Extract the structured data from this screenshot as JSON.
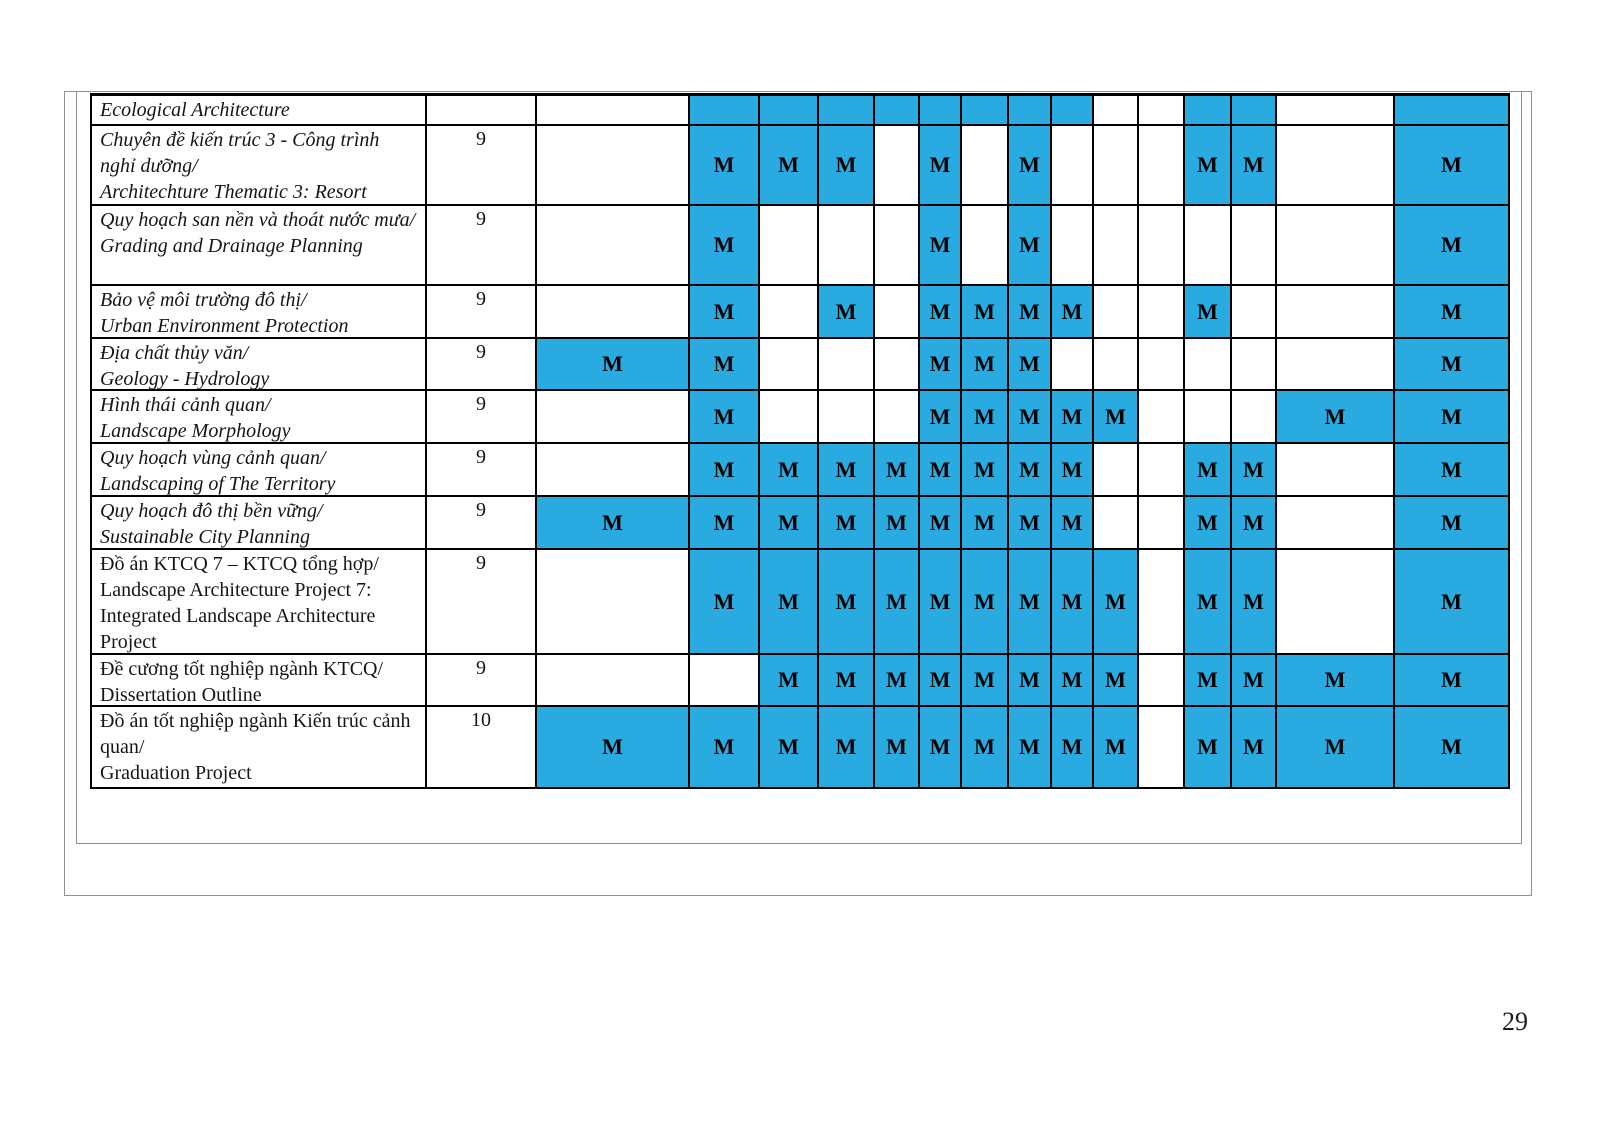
{
  "page": {
    "number": "29"
  },
  "colors": {
    "highlight": "#29ABE2",
    "grid_line": "#000000",
    "frame_line": "#8f8f8f"
  },
  "table": {
    "mark_symbol": "M",
    "name_col_width": 335,
    "semester_col_width": 110,
    "mark_col_widths": [
      153,
      70,
      59,
      56,
      45,
      42,
      47,
      43,
      42,
      45,
      46,
      47,
      45,
      118,
      115
    ],
    "rows": [
      {
        "name_vi": "",
        "name_en": "Ecological Architecture",
        "italic": true,
        "semester": "",
        "height_px": 30,
        "marks": [
          "",
          "B",
          "B",
          "B",
          "B",
          "B",
          "B",
          "B",
          "B",
          "",
          "",
          "B",
          "B",
          "",
          "B"
        ]
      },
      {
        "name_vi": "Chuyên đề kiến trúc 3 - Công trình nghỉ dưỡng/",
        "name_en": "Architechture Thematic 3: Resort",
        "italic": true,
        "semester": "9",
        "height_px": 80,
        "marks": [
          "",
          "M",
          "M",
          "M",
          "",
          "M",
          "",
          "M",
          "",
          "",
          "",
          "M",
          "M",
          "",
          "M"
        ]
      },
      {
        "name_vi": "Quy hoạch san nền và thoát nước mưa/",
        "name_en": "Grading and Drainage Planning",
        "italic": true,
        "semester": "9",
        "height_px": 80,
        "marks": [
          "",
          "M",
          "",
          "",
          "",
          "M",
          "",
          "M",
          "",
          "",
          "",
          "",
          "",
          "",
          "M"
        ]
      },
      {
        "name_vi": "Bảo vệ môi trường đô thị/",
        "name_en": "Urban Environment Protection",
        "italic": true,
        "semester": "9",
        "height_px": 53,
        "marks": [
          "",
          "M",
          "",
          "M",
          "",
          "M",
          "M",
          "M",
          "M",
          "",
          "",
          "M",
          "",
          "",
          "M"
        ]
      },
      {
        "name_vi": "Địa chất thủy văn/",
        "name_en": "Geology - Hydrology",
        "italic": true,
        "semester": "9",
        "height_px": 52,
        "marks": [
          "M",
          "M",
          "",
          "",
          "",
          "M",
          "M",
          "M",
          "",
          "",
          "",
          "",
          "",
          "",
          "M"
        ]
      },
      {
        "name_vi": "Hình thái cảnh quan/",
        "name_en": "Landscape Morphology",
        "italic": true,
        "semester": "9",
        "height_px": 53,
        "marks": [
          "",
          "M",
          "",
          "",
          "",
          "M",
          "M",
          "M",
          "M",
          "M",
          "",
          "",
          "",
          "M",
          "M"
        ]
      },
      {
        "name_vi": "Quy hoạch vùng cảnh quan/",
        "name_en": "Landscaping of The Territory",
        "italic": true,
        "semester": "9",
        "height_px": 53,
        "marks": [
          "",
          "M",
          "M",
          "M",
          "M",
          "M",
          "M",
          "M",
          "M",
          "",
          "",
          "M",
          "M",
          "",
          "M"
        ]
      },
      {
        "name_vi": "Quy hoạch đô thị bền vững/",
        "name_en": "Sustainable City Planning",
        "italic": true,
        "semester": "9",
        "height_px": 53,
        "marks": [
          "M",
          "M",
          "M",
          "M",
          "M",
          "M",
          "M",
          "M",
          "M",
          "",
          "",
          "M",
          "M",
          "",
          "M"
        ]
      },
      {
        "name_vi": "Đồ án KTCQ 7 – KTCQ tổng hợp/",
        "name_en": "Landscape Architecture Project 7: Integrated Landscape Architecture Project",
        "italic": false,
        "semester": "9",
        "height_px": 105,
        "marks": [
          "",
          "M",
          "M",
          "M",
          "M",
          "M",
          "M",
          "M",
          "M",
          "M",
          "",
          "M",
          "M",
          "",
          "M"
        ]
      },
      {
        "name_vi": "Đề cương tốt nghiệp ngành KTCQ/",
        "name_en": "Dissertation Outline",
        "italic": false,
        "semester": "9",
        "height_px": 52,
        "marks": [
          "",
          "",
          "M",
          "M",
          "M",
          "M",
          "M",
          "M",
          "M",
          "M",
          "",
          "M",
          "M",
          "M",
          "M"
        ]
      },
      {
        "name_vi": "Đồ án tốt nghiệp ngành Kiến trúc cảnh quan/",
        "name_en": "Graduation Project",
        "italic": false,
        "semester": "10",
        "height_px": 82,
        "marks": [
          "M",
          "M",
          "M",
          "M",
          "M",
          "M",
          "M",
          "M",
          "M",
          "M",
          "",
          "M",
          "M",
          "M",
          "M"
        ]
      }
    ]
  }
}
